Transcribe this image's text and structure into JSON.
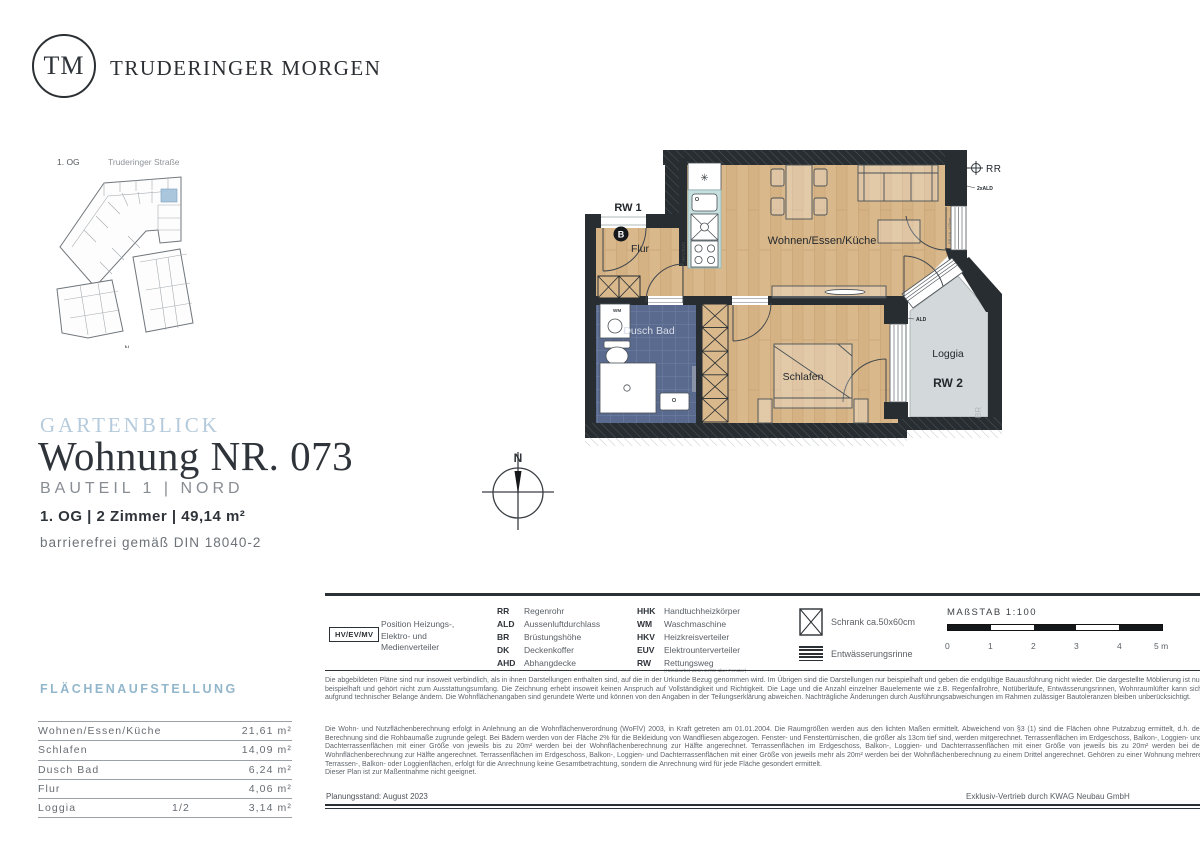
{
  "header": {
    "logo_text": "TM",
    "brand": "TRUDERINGER MORGEN"
  },
  "site_plan": {
    "floor": "1. OG",
    "street": "Truderinger Straße"
  },
  "title_block": {
    "project": "GARTENBLICK",
    "unit": "Wohnung NR. 073",
    "section": "BAUTEIL 1 | NORD",
    "specs": "1. OG | 2 Zimmer | 49,14 m²",
    "accessibility": "barrierefrei gemäß DIN 18040-2"
  },
  "compass": {
    "north": "N"
  },
  "floor_plan": {
    "rooms": {
      "flur": "Flur",
      "wohnen": "Wohnen/Essen/Küche",
      "bad": "Dusch Bad",
      "schlafen": "Schlafen",
      "loggia": "Loggia"
    },
    "annotations": {
      "rw1": "RW 1",
      "rw2": "RW 2",
      "rr": "RR",
      "ald": "ALD",
      "ald2x": "2xALD",
      "wm": "WM",
      "b": "B",
      "hkv_euv": "HKV/EUV",
      "br": "BR",
      "br_height": "BR o.k. +75cm",
      "snowflake": "✳"
    }
  },
  "legend": {
    "hv_box": "HV/EV/MV",
    "hv_label": "Position Heizungs-,\nElektro- und\nMedienverteiler",
    "col1": [
      {
        "abbr": "RR",
        "label": "Regenrohr"
      },
      {
        "abbr": "ALD",
        "label": "Aussenluftdurchlass"
      },
      {
        "abbr": "BR",
        "label": "Brüstungshöhe"
      },
      {
        "abbr": "DK",
        "label": "Deckenkoffer"
      },
      {
        "abbr": "AHD",
        "label": "Abhangdecke"
      }
    ],
    "col2": [
      {
        "abbr": "HHK",
        "label": "Handtuchheizkörper"
      },
      {
        "abbr": "WM",
        "label": "Waschmaschine"
      },
      {
        "abbr": "HKV",
        "label": "Heizkreisverteiler"
      },
      {
        "abbr": "EUV",
        "label": "Elektrounterverteiler"
      },
      {
        "abbr": "RW",
        "label": "Rettungsweg",
        "note": "(Handkurbel wenn 2.RW über Fenster)"
      }
    ],
    "symbols": [
      {
        "label": "Schrank ca.50x60cm"
      },
      {
        "label": "Entwässerungsrinne"
      }
    ]
  },
  "scale_bar": {
    "title": "MAßSTAB 1:100",
    "ticks": [
      "0",
      "1",
      "2",
      "3",
      "4",
      "5 m"
    ]
  },
  "area_table": {
    "heading": "FLÄCHENAUFSTELLUNG",
    "rows": [
      {
        "label": "Wohnen/Essen/Küche",
        "factor": "",
        "value": "21,61 m²"
      },
      {
        "label": "Schlafen",
        "factor": "",
        "value": "14,09 m²"
      },
      {
        "label": "Dusch Bad",
        "factor": "",
        "value": "6,24 m²"
      },
      {
        "label": "Flur",
        "factor": "",
        "value": "4,06 m²"
      },
      {
        "label": "Loggia",
        "factor": "1/2",
        "value": "3,14 m²"
      }
    ]
  },
  "disclaimer": {
    "p1": "Die abgebildeten Pläne sind nur insoweit verbindlich, als in ihnen Darstellungen enthalten sind, auf die in der Urkunde Bezug genommen wird. Im Übrigen sind die Darstellungen nur beispielhaft und geben die endgültige Bauausführung nicht wieder. Die dargestellte Möblierung ist nur beispielhaft und gehört nicht zum Ausstattungsumfang. Die Zeichnung erhebt insoweit keinen Anspruch auf Vollständigkeit und Richtigkeit. Die Lage und die Anzahl einzelner Bauelemente wie z.B. Regenfallrohre, Notüberläufe, Entwässerungsrinnen, Wohnraumlüfter kann sich aufgrund technischer Belange ändern. Die Wohnflächenangaben sind gerundete Werte und können von den Angaben in der Teilungserklärung abweichen. Nachträgliche Änderungen durch Ausführungsabweichungen im Rahmen zulässiger Bautoleranzen bleiben unberücksichtigt.",
    "p2": "Die Wohn- und Nutzflächenberechnung erfolgt in Anlehnung an die Wohnflächenverordnung (WoFlV) 2003, in Kraft getreten am 01.01.2004. Die Raumgrößen werden aus den lichten Maßen ermittelt. Abweichend von §3 (1) sind die Flächen ohne Putzabzug ermittelt, d.h. der Berechnung sind die Rohbaumaße zugrunde gelegt. Bei Bädern werden von der Fläche 2% für die Bekleidung von Wandfliesen abgezogen. Fenster- und Fenstertürnischen, die größer als 13cm tief sind, werden mitgerechnet. Terrassenflächen im Erdgeschoss, Balkon-, Loggien- und Dachterrassenflächen mit einer Größe von jeweils bis zu 20m² werden bei der Wohnflächenberechnung zur Hälfte angerechnet. Terrassenflächen im Erdgeschoss, Balkon-, Loggien- und Dachterrassenflächen mit einer Größe von jeweils bis zu 20m² werden bei der Wohnflächenberechnung zur Hälfte angerechnet. Terrassenflächen im Erdgeschoss, Balkon-, Loggien- und Dachterrassenflächen mit einer Größe von jeweils mehr als 20m² werden bei der Wohnflächenberechnung zu einem Drittel angerechnet. Gehören zu einer Wohnung mehrere Terrassen-, Balkon- oder Loggienflächen, erfolgt für die Anrechnung keine Gesamtbetrachtung, sondern die Anrechnung wird für jede Fläche gesondert ermittelt.",
    "p3": "Dieser Plan ist zur Maßentnahme nicht geeignet."
  },
  "footer": {
    "left": "Planungsstand: August 2023",
    "right": "Exklusiv-Vertrieb durch KWAG Neubau GmbH"
  }
}
